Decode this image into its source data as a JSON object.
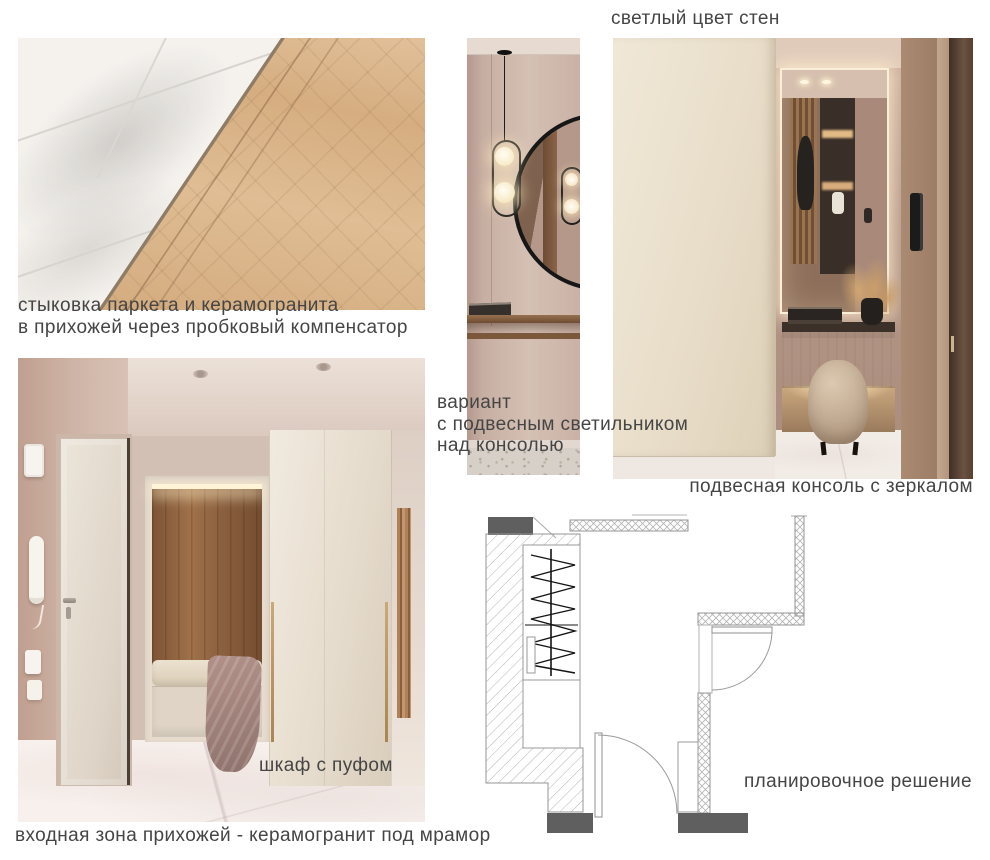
{
  "board": {
    "labels": {
      "wall_color": "светлый цвет стен",
      "parquet_joint_1": "стыковка паркета и керамогранита",
      "parquet_joint_2": "в прихожей через пробковый компенсатор",
      "pendant_option_1": "вариант",
      "pendant_option_2": "с подвесным светильником",
      "pendant_option_3": "над консолью",
      "hanging_console": "подвесная консоль с зеркалом",
      "wardrobe_pouf": "шкаф с пуфом",
      "entrance_zone": "входная зона прихожей - керамогранит под мрамор",
      "floor_plan": "планировочное решение"
    },
    "colors": {
      "label_text": "#454545",
      "plan_fill_dark": "#5f5f5f",
      "plan_lines": "#949494",
      "wood_parquet": "#d6b088",
      "marble_tile": "#f4f1ed",
      "wall_pink": "#cdb5aa",
      "cream_panel": "#e9dfcc",
      "walnut_niche": "#8a5f3f",
      "brass_handle": "#bfa16b",
      "mauve_blanket": "#a98a82"
    }
  }
}
